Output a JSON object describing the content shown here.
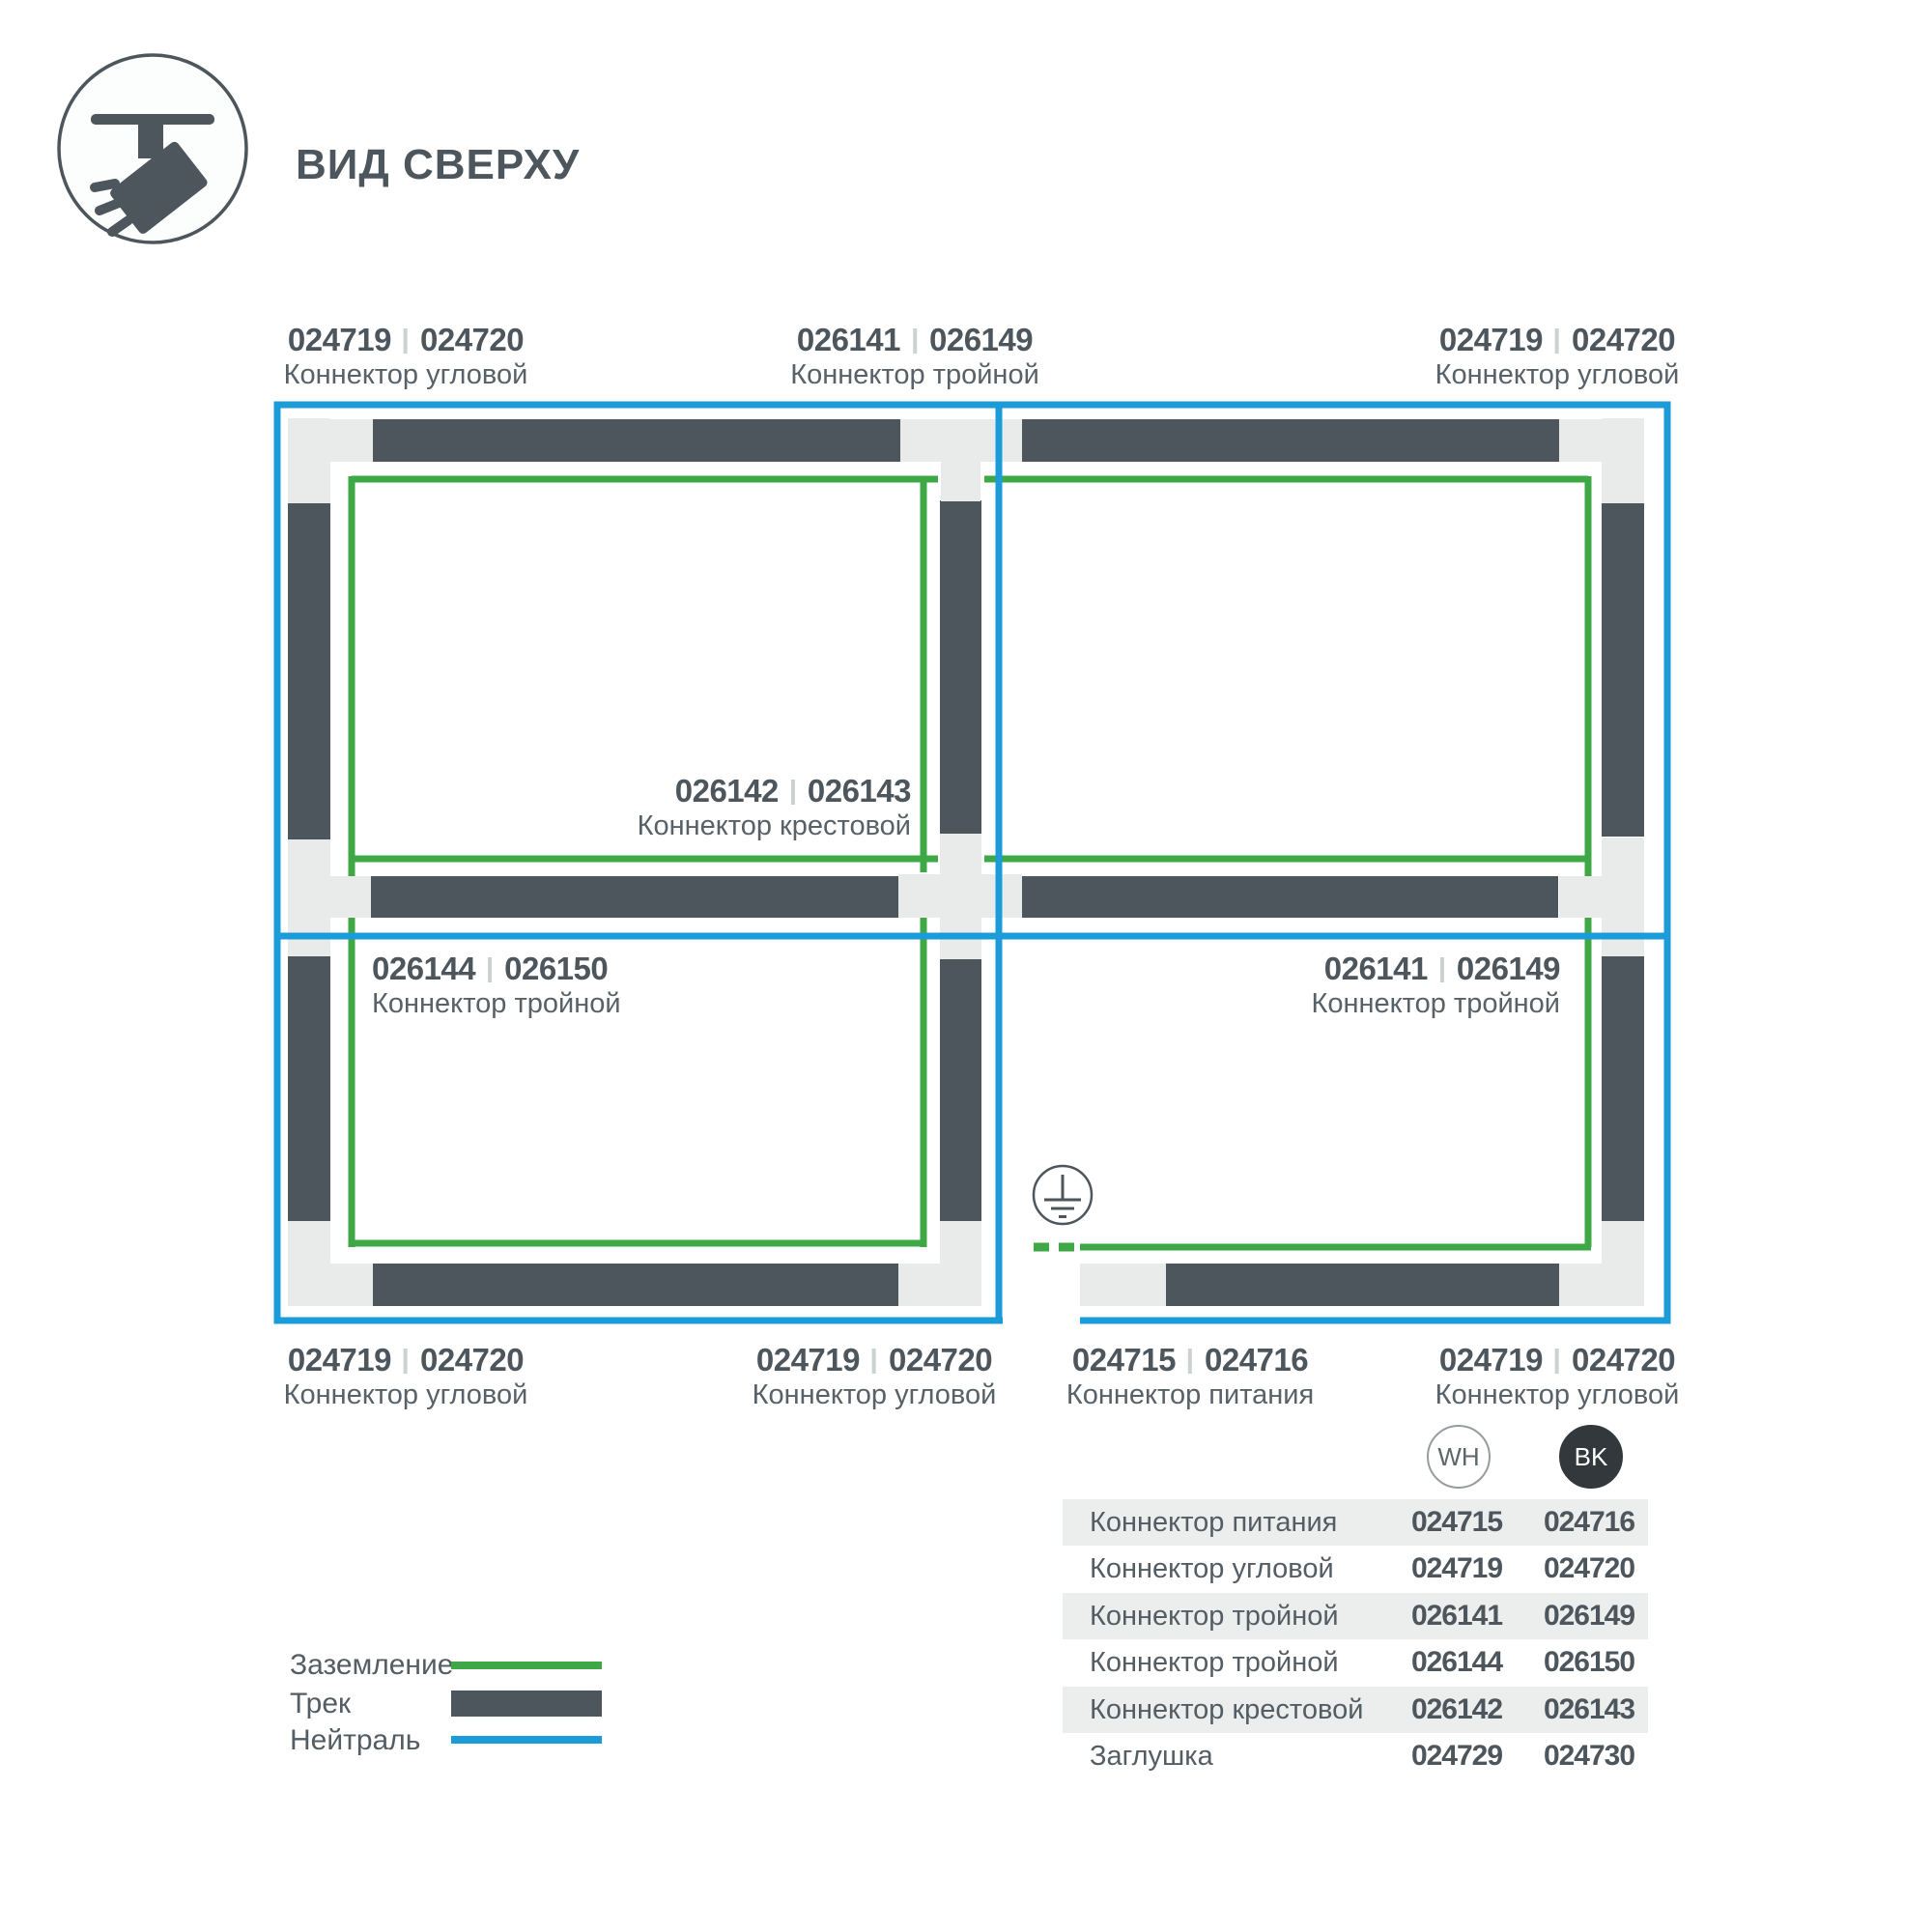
{
  "header": {
    "title": "ВИД СВЕРХУ",
    "icon": "track-spotlight-icon"
  },
  "colors": {
    "ground_green": "#3EA846",
    "neutral_blue": "#1B9CD9",
    "track_dark": "#4D565C",
    "connector_grey": "#E9EBEB",
    "table_row_bg": "#ECEEEE",
    "bk_badge": "#32383C"
  },
  "diagram": {
    "ground_symbol": "earth-ground-icon",
    "labels": [
      {
        "num1": "024719",
        "num2": "024720",
        "name": "Коннектор угловой"
      },
      {
        "num1": "026141",
        "num2": "026149",
        "name": "Коннектор тройной"
      },
      {
        "num1": "024719",
        "num2": "024720",
        "name": "Коннектор угловой"
      },
      {
        "num1": "026142",
        "num2": "026143",
        "name": "Коннектор крестовой"
      },
      {
        "num1": "026144",
        "num2": "026150",
        "name": "Коннектор тройной"
      },
      {
        "num1": "026141",
        "num2": "026149",
        "name": "Коннектор тройной"
      },
      {
        "num1": "024719",
        "num2": "024720",
        "name": "Коннектор угловой"
      },
      {
        "num1": "024719",
        "num2": "024720",
        "name": "Коннектор угловой"
      },
      {
        "num1": "024715",
        "num2": "024716",
        "name": "Коннектор питания"
      },
      {
        "num1": "024719",
        "num2": "024720",
        "name": "Коннектор угловой"
      }
    ]
  },
  "legend": {
    "items": [
      {
        "label": "Заземление",
        "swatch": "green-line"
      },
      {
        "label": "Трек",
        "swatch": "dark-bar"
      },
      {
        "label": "Нейтраль",
        "swatch": "blue-line"
      }
    ]
  },
  "table": {
    "columns": [
      {
        "code": "WH"
      },
      {
        "code": "BK"
      }
    ],
    "rows": [
      {
        "name": "Коннектор питания",
        "wh": "024715",
        "bk": "024716"
      },
      {
        "name": "Коннектор угловой",
        "wh": "024719",
        "bk": "024720"
      },
      {
        "name": "Коннектор тройной",
        "wh": "026141",
        "bk": "026149"
      },
      {
        "name": "Коннектор тройной",
        "wh": "026144",
        "bk": "026150"
      },
      {
        "name": "Коннектор крестовой",
        "wh": "026142",
        "bk": "026143"
      },
      {
        "name": "Заглушка",
        "wh": "024729",
        "bk": "024730"
      }
    ]
  }
}
